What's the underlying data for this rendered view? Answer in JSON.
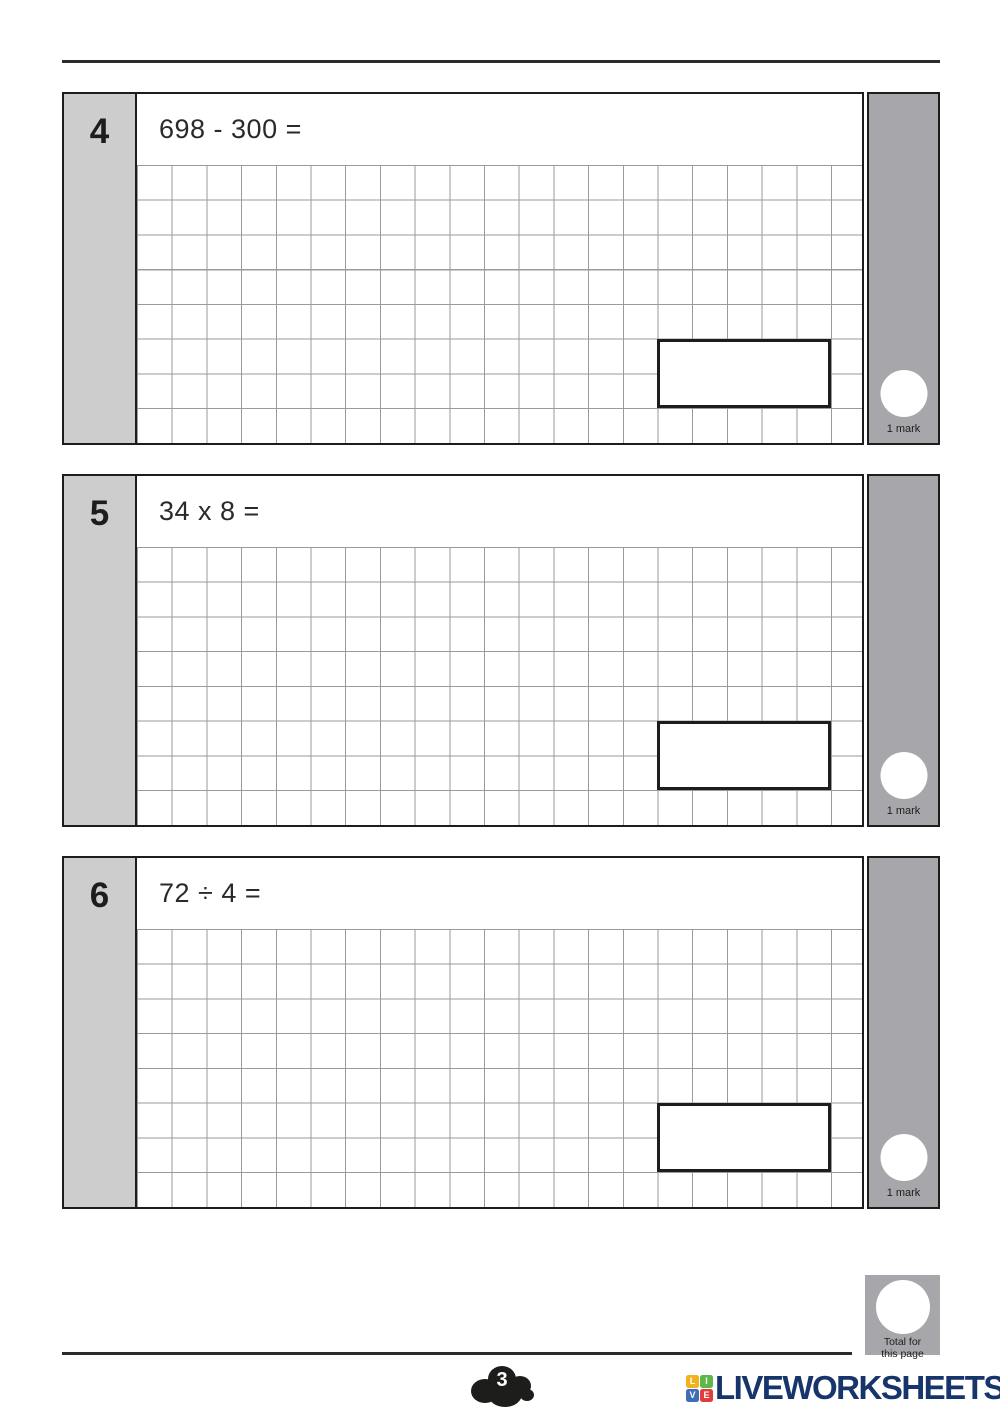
{
  "worksheet": {
    "questions": [
      {
        "number": "4",
        "prompt": "698 - 300 =",
        "marks": "1 mark"
      },
      {
        "number": "5",
        "prompt": "34 x 8 =",
        "marks": "1 mark"
      },
      {
        "number": "6",
        "prompt": "72 ÷ 4 =",
        "marks": "1 mark"
      }
    ]
  },
  "footer": {
    "page_number": "3",
    "total_line1": "Total for",
    "total_line2": "this page"
  },
  "brand": {
    "name": "LIVEWORKSHEETS",
    "icon_letters": [
      "L",
      "I",
      "V",
      "E"
    ],
    "icon_colors": [
      "#f2b21c",
      "#5cb947",
      "#3e6eb5",
      "#e23d3d"
    ],
    "name_color": "#17356b"
  },
  "colors": {
    "question_number_bg": "#cdcdcd",
    "marks_column_bg": "#a7a7ab",
    "grid_line": "#9a9a9a",
    "border": "#1d1d1b",
    "rule": "#2b2b2b"
  }
}
